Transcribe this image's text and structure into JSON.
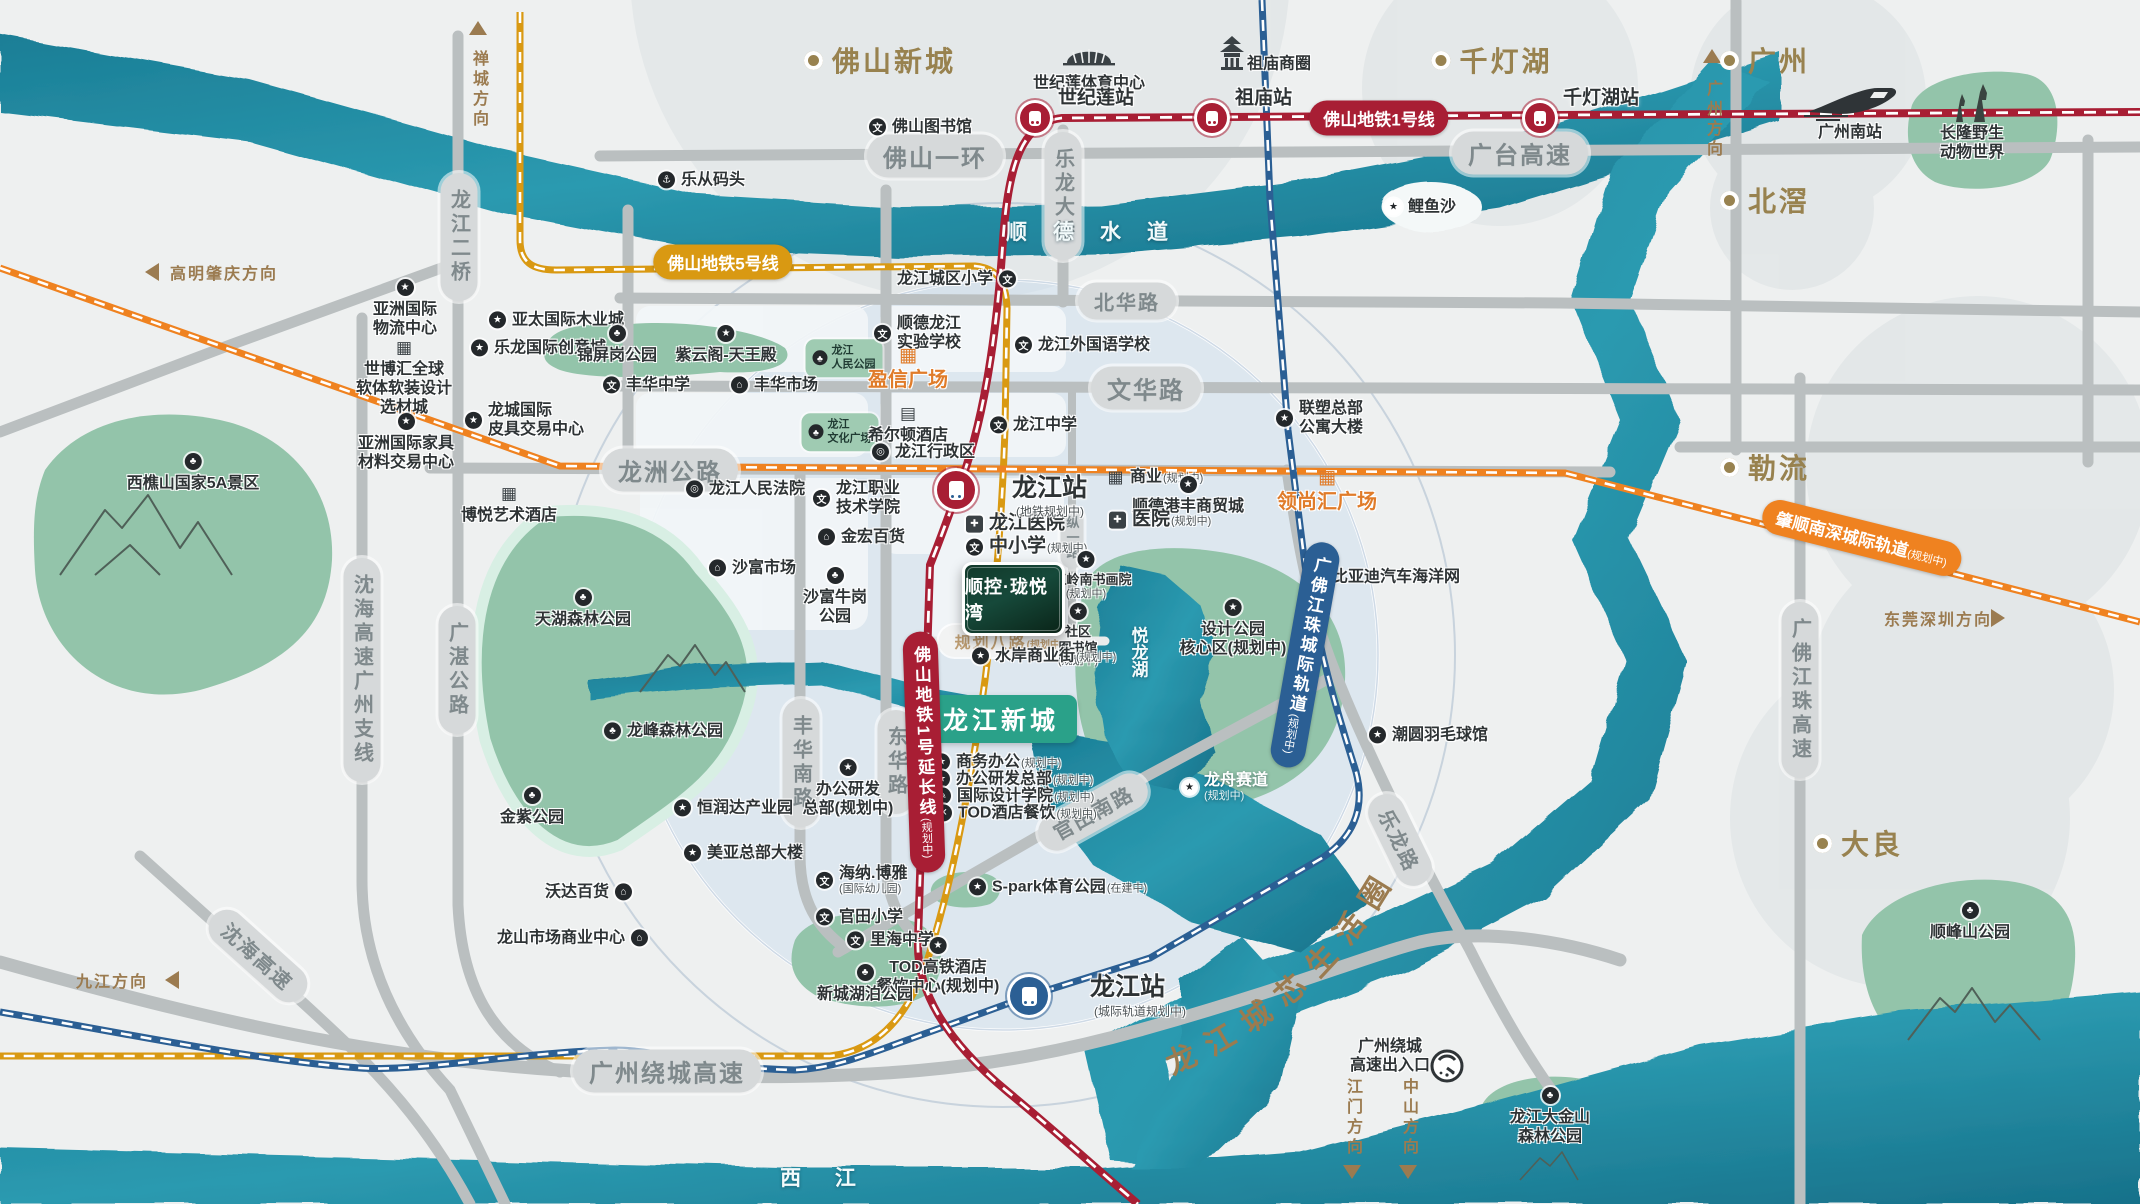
{
  "meta": {
    "title": "顺控·珑悦湾 区位示意图"
  },
  "colors": {
    "river": "#1f869d",
    "river_dark": "#156e86",
    "park": "#93c4aa",
    "road": "#babfc0",
    "metro_red": "#a81e34",
    "metro_gold": "#d99912",
    "rail_orange": "#ef8220",
    "rail_blue": "#2b5f94",
    "brown": "#98824f",
    "accent_teal": "#2aa189",
    "orange_text": "#e07c2a"
  },
  "project": {
    "logo_text": "顺控·珑悦湾",
    "newtown_badge": "龙江新城",
    "life_circle_text": "龙江城芯生活圈"
  },
  "waters": [
    {
      "t": "顺德水道",
      "x": 1100,
      "y": 231,
      "ls": 26
    },
    {
      "t": "西  江",
      "x": 825,
      "y": 1177,
      "ls": 14
    },
    {
      "t": "悦龙湖",
      "x": 1138,
      "y": 652,
      "v": 1
    }
  ],
  "areas": [
    {
      "t": "佛山新城",
      "x": 880,
      "y": 60
    },
    {
      "t": "千灯湖",
      "x": 1492,
      "y": 60
    },
    {
      "t": "广州",
      "x": 1765,
      "y": 60
    },
    {
      "t": "北滘",
      "x": 1765,
      "y": 200
    },
    {
      "t": "勒流",
      "x": 1765,
      "y": 467
    },
    {
      "t": "大良",
      "x": 1858,
      "y": 843
    }
  ],
  "stations": [
    {
      "t": "世纪莲站",
      "x": 1035,
      "y": 118,
      "lx": 1058,
      "ly": 96
    },
    {
      "t": "祖庙站",
      "x": 1212,
      "y": 118,
      "lx": 1235,
      "ly": 96
    },
    {
      "t": "千灯湖站",
      "x": 1540,
      "y": 118,
      "lx": 1563,
      "ly": 96
    },
    {
      "t": "龙江站",
      "sub": "(地铁规划中)",
      "x": 956,
      "y": 490,
      "lx": 1012,
      "ly": 486,
      "sx": 1016,
      "sy": 511,
      "big": 1
    },
    {
      "t": "龙江站",
      "sub": "(城际轨道规划中)",
      "x": 1029,
      "y": 996,
      "lx": 1090,
      "ly": 985,
      "sx": 1094,
      "sy": 1011,
      "big": 1,
      "c": "blue"
    }
  ],
  "badges": [
    {
      "t": "佛山地铁1号线",
      "x": 1379,
      "y": 118,
      "c": "red"
    },
    {
      "t": "佛山地铁5号线",
      "x": 723,
      "y": 262,
      "c": "gold"
    },
    {
      "t": "佛山地铁1号延长线",
      "sub": "(规划中)",
      "x": 924,
      "y": 752,
      "c": "red",
      "v": 1,
      "rot": -2
    },
    {
      "t": "肇顺南深城际轨道",
      "sub": "(规划中)",
      "x": 1862,
      "y": 538,
      "c": "orange",
      "rot": 14
    },
    {
      "t": "广佛江珠城际轨道",
      "sub": "(规划中)",
      "x": 1305,
      "y": 655,
      "c": "blue",
      "v": 1,
      "rot": 10
    }
  ],
  "pills": [
    {
      "t": "佛山一环",
      "x": 935,
      "y": 156,
      "cls": "lg"
    },
    {
      "t": "广台高速",
      "x": 1520,
      "y": 153,
      "cls": "lg"
    },
    {
      "t": "北华路",
      "x": 1127,
      "y": 301
    },
    {
      "t": "文华路",
      "x": 1146,
      "y": 388,
      "cls": "lg"
    },
    {
      "t": "龙洲公路",
      "x": 670,
      "y": 470,
      "cls": "lg"
    },
    {
      "t": "龙江二桥",
      "x": 459,
      "y": 237,
      "v": 1
    },
    {
      "t": "乐龙大桥",
      "x": 1063,
      "y": 196,
      "v": 1
    },
    {
      "t": "沈海高速广州支线",
      "x": 362,
      "y": 670,
      "v": 1
    },
    {
      "t": "广湛公路",
      "x": 457,
      "y": 670,
      "v": 1
    },
    {
      "t": "丰华南路",
      "x": 801,
      "y": 763,
      "v": 1
    },
    {
      "t": "东华路",
      "x": 896,
      "y": 762,
      "v": 1
    },
    {
      "t": "纵一路",
      "x": 1072,
      "y": 538,
      "v": 1,
      "cls": "sm"
    },
    {
      "t": "官田南路",
      "x": 1093,
      "y": 812,
      "rot": -29
    },
    {
      "t": "乐龙路",
      "x": 1400,
      "y": 840,
      "rot": 64
    },
    {
      "t": "广州绕城高速",
      "x": 667,
      "y": 1071,
      "cls": "lg"
    },
    {
      "t": "沈海高速",
      "x": 258,
      "y": 956,
      "rot": 42
    },
    {
      "t": "广佛江珠高速",
      "x": 1800,
      "y": 690,
      "v": 1
    },
    {
      "t": "规划八路",
      "sub": "(规划中)",
      "x": 1009,
      "y": 641,
      "cls": "plan"
    }
  ],
  "directions": [
    {
      "t": "禅城方向",
      "x": 478,
      "y": 90,
      "v": 1,
      "arrow": "up",
      "ax": 478,
      "ay": 28
    },
    {
      "t": "广州方向",
      "x": 1712,
      "y": 120,
      "v": 1,
      "arrow": "up",
      "ax": 1712,
      "ay": 56
    },
    {
      "t": "高明肇庆方向",
      "x": 170,
      "y": 272,
      "arrow": "left",
      "ax": 152,
      "ay": 272
    },
    {
      "t": "九江方向",
      "x": 76,
      "y": 980,
      "arrow": "left",
      "ax": 172,
      "ay": 980
    },
    {
      "t": "东莞深圳方向",
      "x": 1884,
      "y": 618,
      "arrow": "right",
      "ax": 1998,
      "ay": 618
    },
    {
      "t": "江门方向",
      "x": 1352,
      "y": 1118,
      "v": 1,
      "arrow": "down",
      "ax": 1352,
      "ay": 1172
    },
    {
      "t": "中山方向",
      "x": 1408,
      "y": 1118,
      "v": 1,
      "arrow": "down",
      "ax": 1408,
      "ay": 1172
    }
  ],
  "greenboxes": [
    {
      "lines": [
        "龙江",
        "人民公园"
      ],
      "x": 844,
      "y": 358
    },
    {
      "lines": [
        "龙江",
        "文化广场"
      ],
      "x": 840,
      "y": 432
    }
  ],
  "parks_note": "park name labels are in pois",
  "pois": [
    {
      "text": "乐从码头",
      "icon": "anchor",
      "x": 667,
      "y": 180
    },
    {
      "text": "佛山图书馆",
      "icon": "school",
      "x": 878,
      "y": 127
    },
    {
      "text": "世纪莲体育中心",
      "icon": "none",
      "x": 1089,
      "y": 83,
      "dir": "b"
    },
    {
      "text": "祖庙商圈",
      "icon": "none",
      "x": 1256,
      "y": 64
    },
    {
      "text": "广州南站",
      "icon": "none",
      "x": 1850,
      "y": 132,
      "dir": "b"
    },
    {
      "lines": [
        "长隆野生",
        "动物世界"
      ],
      "icon": "none",
      "x": 1972,
      "y": 133,
      "dir": "b"
    },
    {
      "text": "鲤鱼沙",
      "icon": "star_light",
      "x": 1394,
      "y": 207
    },
    {
      "text": "亚太国际木业城",
      "icon": "star",
      "x": 498,
      "y": 320
    },
    {
      "text": "乐龙国际创意城",
      "icon": "star",
      "x": 480,
      "y": 348
    },
    {
      "text": "锦屏岗公园",
      "icon": "tree",
      "x": 617,
      "y": 334,
      "dir": "b"
    },
    {
      "text": "紫云阁-天王殿",
      "icon": "star",
      "x": 726,
      "y": 334,
      "dir": "b"
    },
    {
      "text": "丰华中学",
      "icon": "school",
      "x": 612,
      "y": 385
    },
    {
      "text": "丰华市场",
      "icon": "market",
      "x": 740,
      "y": 385
    },
    {
      "lines": [
        "龙城国际",
        "皮具交易中心"
      ],
      "icon": "star",
      "x": 474,
      "y": 420
    },
    {
      "lines": [
        "亚洲国际",
        "物流中心"
      ],
      "icon": "star",
      "x": 405,
      "y": 288,
      "dir": "b"
    },
    {
      "lines": [
        "世博汇全球",
        "软体软装设计",
        "选材城"
      ],
      "icon": "building",
      "x": 404,
      "y": 348,
      "dir": "b"
    },
    {
      "lines": [
        "亚洲国际家具",
        "材料交易中心"
      ],
      "icon": "star",
      "x": 406,
      "y": 422,
      "dir": "b"
    },
    {
      "text": "西樵山国家5A景区",
      "icon": "tree",
      "x": 193,
      "y": 462,
      "dir": "b"
    },
    {
      "text": "博悦艺术酒店",
      "icon": "building",
      "x": 509,
      "y": 494,
      "dir": "b"
    },
    {
      "text": "龙江人民法院",
      "icon": "gov",
      "x": 695,
      "y": 489
    },
    {
      "lines": [
        "龙江职业",
        "技术学院"
      ],
      "icon": "school",
      "x": 822,
      "y": 498
    },
    {
      "text": "金宏百货",
      "icon": "market",
      "x": 827,
      "y": 537
    },
    {
      "text": "沙富市场",
      "icon": "market",
      "x": 718,
      "y": 568
    },
    {
      "lines": [
        "沙富牛岗",
        "公园"
      ],
      "icon": "tree",
      "x": 835,
      "y": 576,
      "dir": "b"
    },
    {
      "text": "天湖森林公园",
      "icon": "tree",
      "x": 583,
      "y": 598,
      "dir": "b"
    },
    {
      "text": "龙峰森林公园",
      "icon": "tree",
      "x": 613,
      "y": 731
    },
    {
      "text": "金紫公园",
      "icon": "tree",
      "x": 532,
      "y": 796,
      "dir": "b"
    },
    {
      "text": "恒润达产业园",
      "icon": "star",
      "x": 683,
      "y": 808
    },
    {
      "text": "美亚总部大楼",
      "icon": "star",
      "x": 693,
      "y": 853
    },
    {
      "text": "沃达百货",
      "icon": "market",
      "x": 623,
      "y": 892,
      "dir": "l"
    },
    {
      "text": "龙山市场商业中心",
      "icon": "market",
      "x": 639,
      "y": 938,
      "dir": "l"
    },
    {
      "lines": [
        "海纳.博雅",
        "(国际幼儿园)"
      ],
      "icon": "school",
      "x": 825,
      "y": 880
    },
    {
      "text": "官田小学",
      "icon": "school",
      "x": 825,
      "y": 917
    },
    {
      "text": "里海中学",
      "icon": "school",
      "x": 856,
      "y": 940
    },
    {
      "lines": [
        "TOD高铁酒店",
        "餐饮中心(规划中)"
      ],
      "icon": "star",
      "x": 938,
      "y": 946,
      "dir": "b"
    },
    {
      "text": "新城湖泊公园",
      "icon": "tree",
      "x": 865,
      "y": 973,
      "dir": "b"
    },
    {
      "text": "龙江城区小学",
      "icon": "school",
      "x": 1007,
      "y": 279,
      "dir": "l"
    },
    {
      "lines": [
        "顺德龙江",
        "实验学校"
      ],
      "icon": "school",
      "x": 883,
      "y": 333
    },
    {
      "text": "龙江外国语学校",
      "icon": "school",
      "x": 1024,
      "y": 345
    },
    {
      "text": "盈信广场",
      "icon": "building_o",
      "x": 908,
      "y": 356,
      "dir": "b",
      "cls": "org"
    },
    {
      "text": "希尔顿酒店",
      "icon": "hotel",
      "x": 908,
      "y": 414,
      "dir": "b"
    },
    {
      "text": "龙江行政区",
      "icon": "gov",
      "x": 881,
      "y": 452
    },
    {
      "text": "龙江中学",
      "icon": "school",
      "x": 999,
      "y": 425
    },
    {
      "lines": [
        "联塑总部",
        "公寓大楼"
      ],
      "icon": "star",
      "x": 1285,
      "y": 418
    },
    {
      "text": "商业",
      "sub": "(规划中)",
      "icon": "building",
      "x": 1116,
      "y": 477
    },
    {
      "text": "顺德港丰商贸城",
      "icon": "star",
      "x": 1188,
      "y": 485,
      "dir": "b"
    },
    {
      "text": "医院",
      "sub": "(规划中)",
      "icon": "hospital",
      "x": 1118,
      "y": 520,
      "cls": "big"
    },
    {
      "text": "领尚汇广场",
      "icon": "building_o",
      "x": 1327,
      "y": 478,
      "dir": "b",
      "cls": "org"
    },
    {
      "text": "比亚迪汽车海洋网",
      "icon": "star",
      "x": 1318,
      "y": 577
    },
    {
      "text": "龙江医院",
      "icon": "hospital",
      "x": 975,
      "y": 524,
      "cls": "big"
    },
    {
      "text": "中小学",
      "sub": "(规划中)",
      "icon": "school",
      "x": 975,
      "y": 547,
      "cls": "big"
    },
    {
      "lines": [
        "龙江岭南书画院",
        "(规划中)"
      ],
      "icon": "star",
      "x": 1086,
      "y": 560,
      "dir": "b",
      "cls": "sm"
    },
    {
      "lines": [
        "社区",
        "图书馆",
        "(规划中)"
      ],
      "icon": "star",
      "x": 1078,
      "y": 612,
      "dir": "b",
      "cls": "sm"
    },
    {
      "lines": [
        "设计公园",
        "核心区(规划中)"
      ],
      "icon": "star",
      "x": 1233,
      "y": 608,
      "dir": "b"
    },
    {
      "text": "水岸商业街",
      "sub": "(规划中)",
      "icon": "star",
      "x": 981,
      "y": 656
    },
    {
      "text": "商务办公",
      "sub": "(规划中)",
      "icon": "star",
      "x": 942,
      "y": 762
    },
    {
      "text": "办公研发总部",
      "sub": "(规划中)",
      "icon": "star",
      "x": 942,
      "y": 779
    },
    {
      "text": "国际设计学院",
      "sub": "(规划中)",
      "icon": "pen",
      "x": 943,
      "y": 796
    },
    {
      "text": "TOD酒店餐饮",
      "sub": "(规划中)",
      "icon": "x",
      "x": 944,
      "y": 813
    },
    {
      "lines": [
        "办公研发",
        "总部(规划中)"
      ],
      "icon": "star",
      "x": 848,
      "y": 768,
      "dir": "b"
    },
    {
      "text": "S-park体育公园",
      "sub": "(在建中)",
      "icon": "star",
      "x": 978,
      "y": 887
    },
    {
      "text": "潮圆羽毛球馆",
      "icon": "star",
      "x": 1378,
      "y": 735
    },
    {
      "lines": [
        "龙舟赛道",
        "(规划中)"
      ],
      "icon": "star_light",
      "x": 1190,
      "y": 787,
      "cls": "wht"
    },
    {
      "text": "顺峰山公园",
      "icon": "tree",
      "x": 1970,
      "y": 911,
      "dir": "b"
    },
    {
      "lines": [
        "龙江大金山",
        "森林公园"
      ],
      "icon": "tree",
      "x": 1550,
      "y": 1096,
      "dir": "b"
    },
    {
      "lines": [
        "广州绕城",
        "高速出入口"
      ],
      "icon": "none",
      "x": 1390,
      "y": 1046,
      "dir": "b"
    }
  ]
}
